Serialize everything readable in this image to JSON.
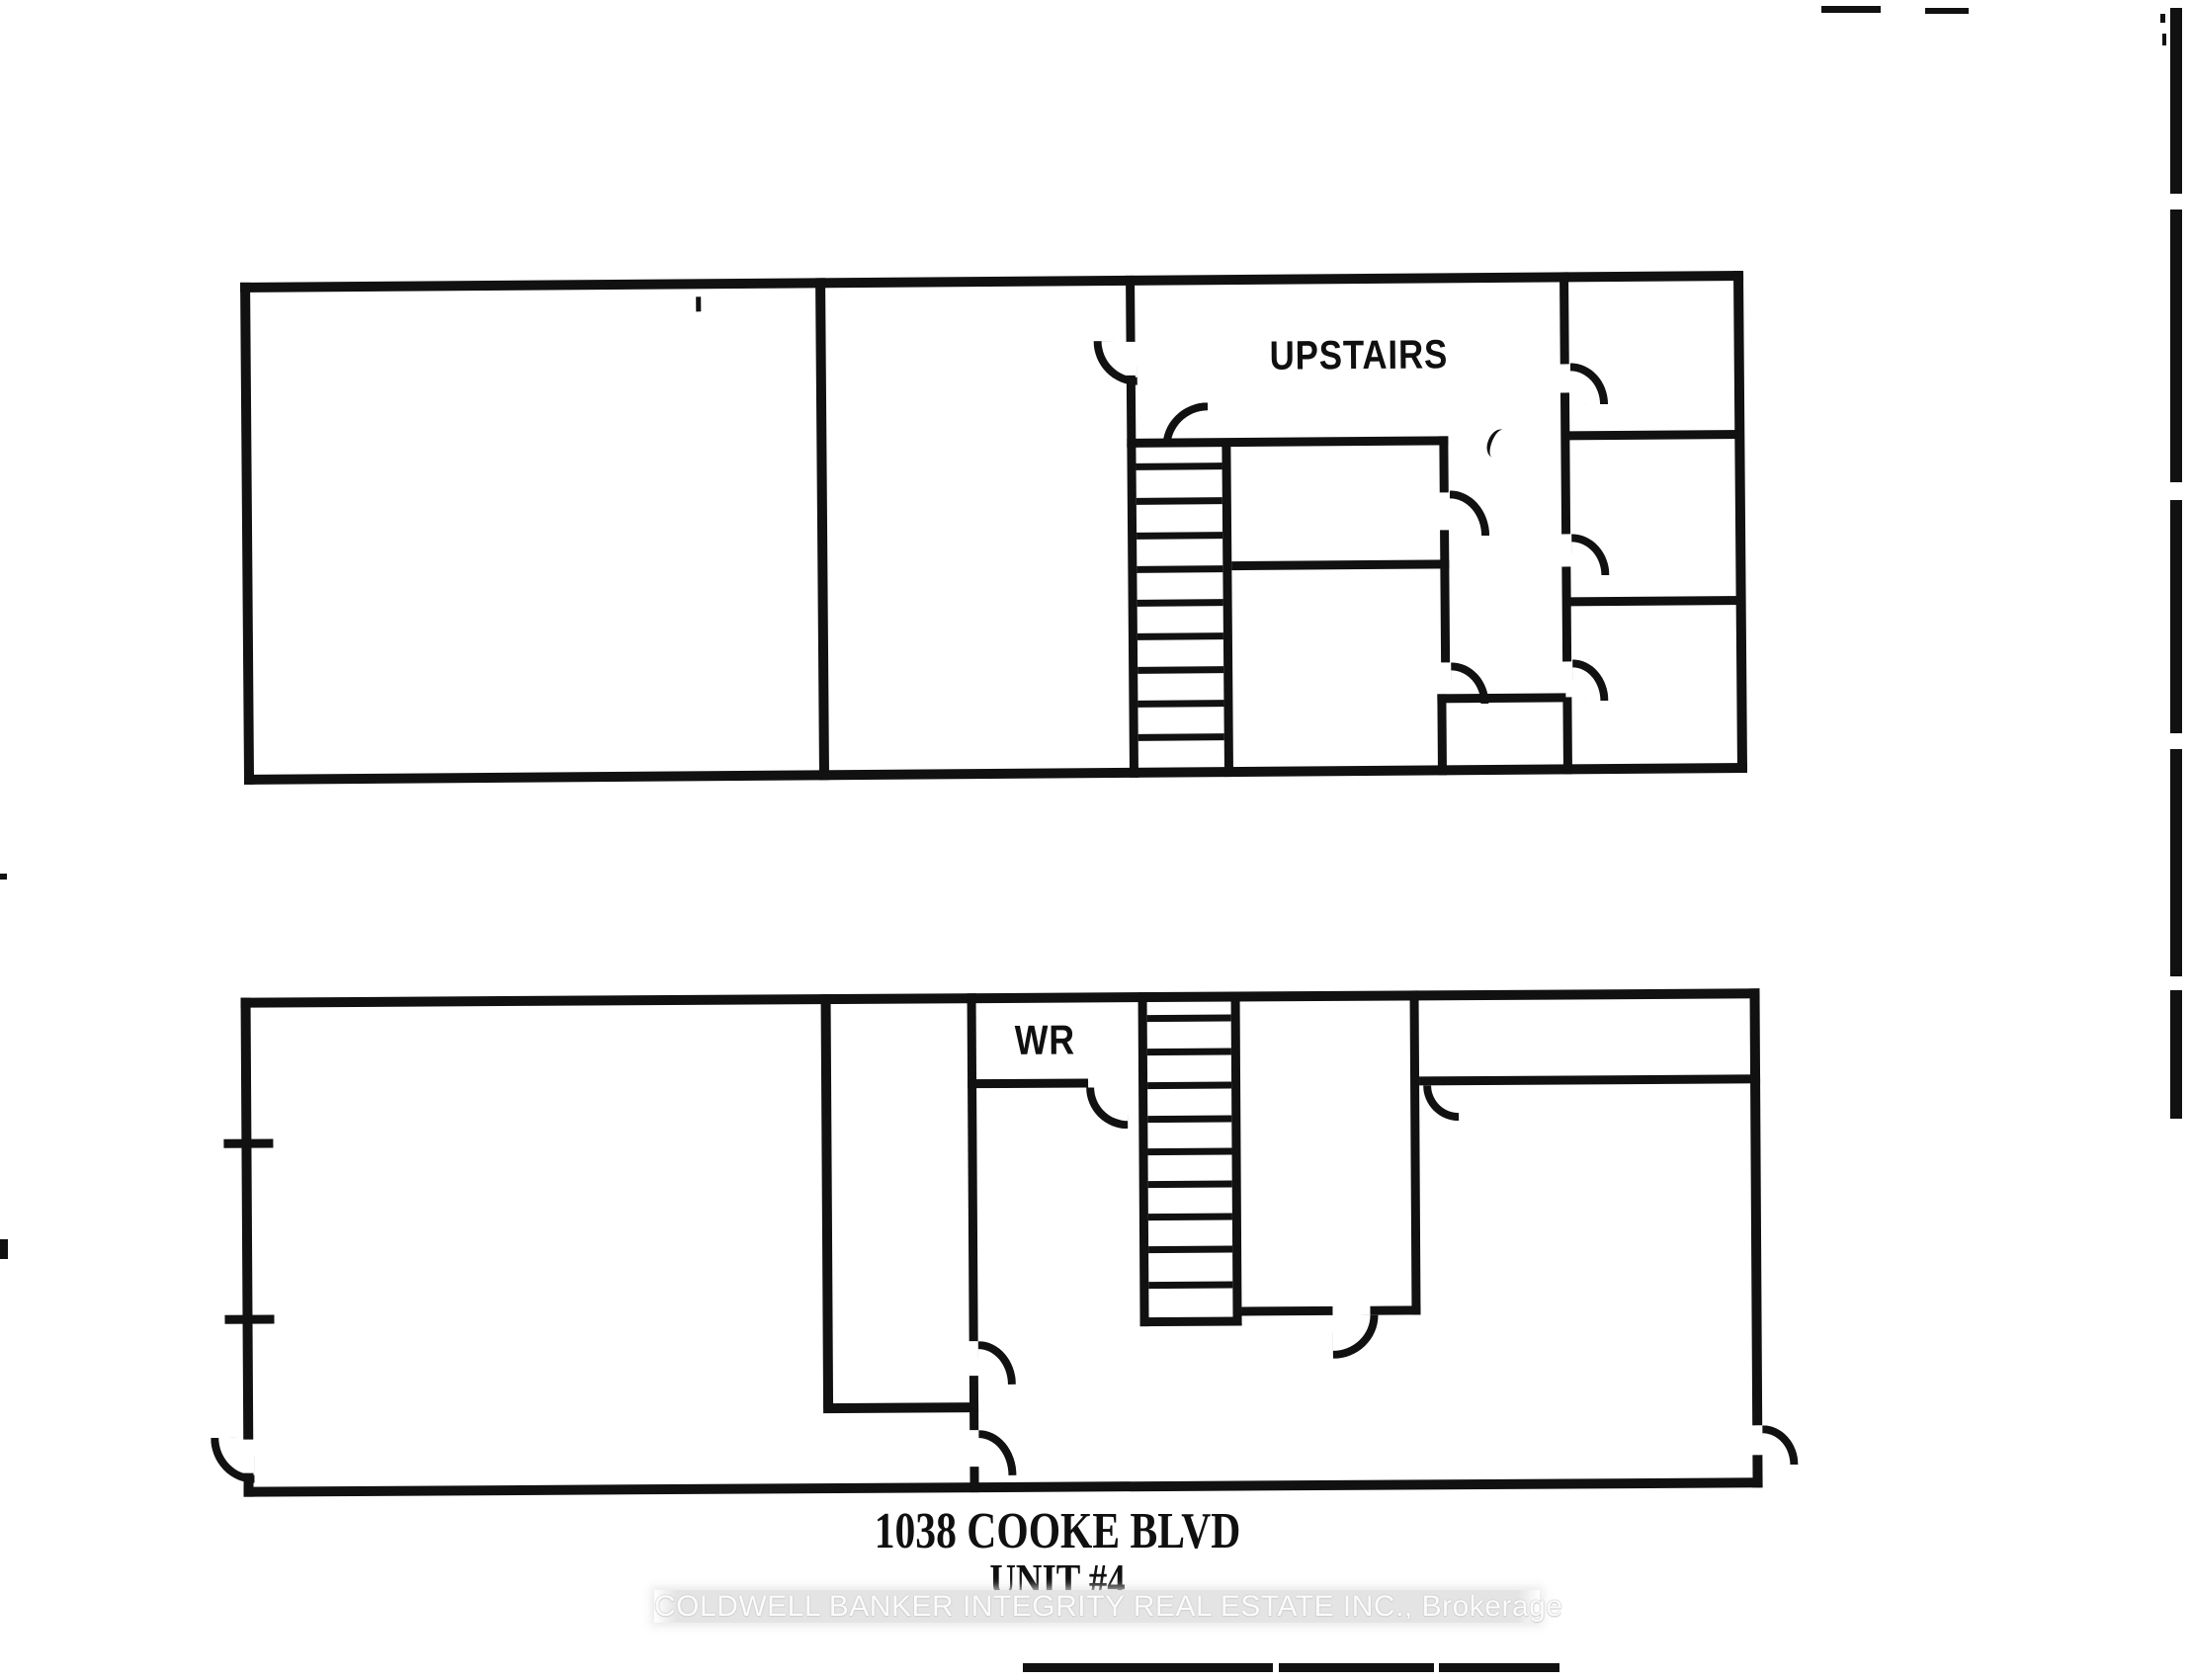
{
  "colors": {
    "background": "#ffffff",
    "wall": "#111111",
    "ink": "#101010",
    "watermark_band": "#e4e4e4",
    "watermark_text": "#fbfbfb"
  },
  "upper_plan": {
    "label": "UPSTAIRS"
  },
  "lower_plan": {
    "washroom_label": "WR"
  },
  "address": {
    "line1": "1038 COOKE BLVD",
    "line2": "UNIT #4"
  },
  "watermark": {
    "text": "COLDWELL BANKER INTEGRITY REAL ESTATE INC., Brokerage"
  }
}
